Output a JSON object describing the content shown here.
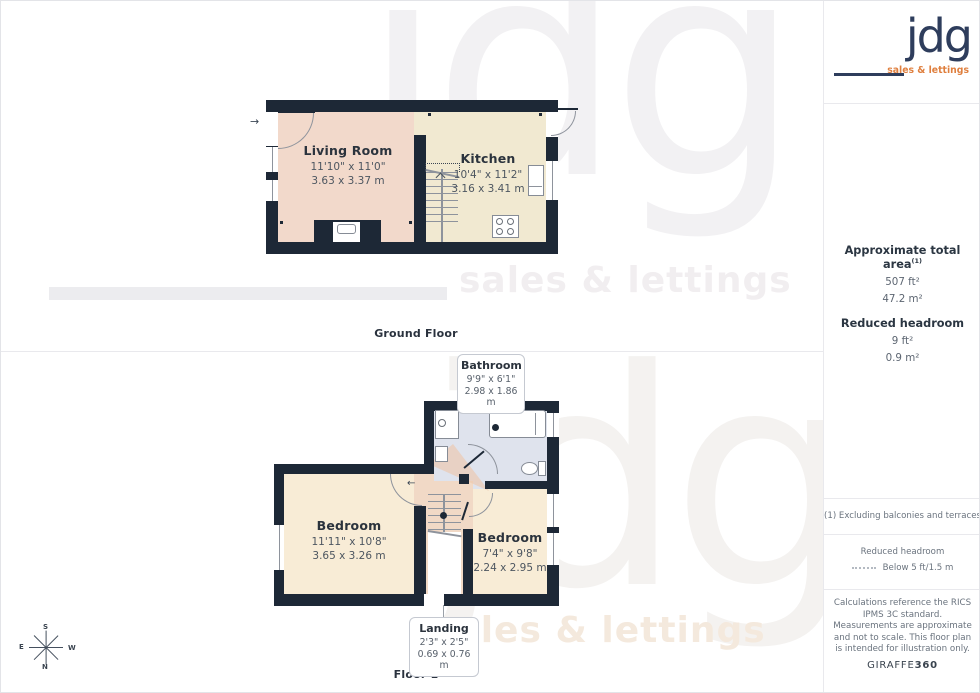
{
  "branding": {
    "logo_text": "jdg",
    "logo_tagline": "sales & lettings",
    "watermark_word": "jdg",
    "watermark_tagline": "sales & lettings",
    "provider": "GIRAFFE",
    "provider_suffix": "360",
    "colors": {
      "navy": "#2e3d5c",
      "orange": "#df7f3e",
      "wall": "#1d2836",
      "living": "#f2d9cb",
      "kitchen": "#f1e9d1",
      "bedroom": "#f8ecd6",
      "landing": "#f1d9c6",
      "bathroom": "#dfe3ed"
    }
  },
  "floors": [
    {
      "label": "Ground Floor",
      "rooms": [
        {
          "name": "Living Room",
          "imperial": "11'10\" x 11'0\"",
          "metric": "3.63 x 3.37 m"
        },
        {
          "name": "Kitchen",
          "imperial": "10'4\" x 11'2\"",
          "metric": "3.16 x 3.41 m"
        }
      ]
    },
    {
      "label": "Floor 1",
      "rooms": [
        {
          "name": "Bedroom",
          "imperial": "11'11\" x 10'8\"",
          "metric": "3.65 x 3.26 m"
        },
        {
          "name": "Bedroom",
          "imperial": "7'4\" x 9'8\"",
          "metric": "2.24 x 2.95 m"
        }
      ],
      "callouts": [
        {
          "name": "Bathroom",
          "imperial": "9'9\" x 6'1\"",
          "metric": "2.98 x 1.86 m"
        },
        {
          "name": "Landing",
          "imperial": "2'3\" x 2'5\"",
          "metric": "0.69 x 0.76 m"
        }
      ]
    }
  ],
  "sidebar": {
    "area_title": "Approximate total area",
    "area_note_ref": "(1)",
    "area_imperial": "507 ft²",
    "area_metric": "47.2 m²",
    "headroom_title": "Reduced headroom",
    "headroom_imperial": "9 ft²",
    "headroom_metric": "0.9 m²",
    "footnote": "(1) Excluding balconies and terraces",
    "legend_title": "Reduced headroom",
    "legend_value": "Below 5 ft/1.5 m",
    "disclaimer": "Calculations reference the RICS IPMS 3C standard. Measurements are approximate and not to scale. This floor plan is intended for illustration only."
  },
  "compass": {
    "north": "N",
    "south": "S",
    "east": "E",
    "west": "W"
  },
  "icons": {
    "entry_arrow": "→",
    "door_swing_arrow": "←"
  }
}
